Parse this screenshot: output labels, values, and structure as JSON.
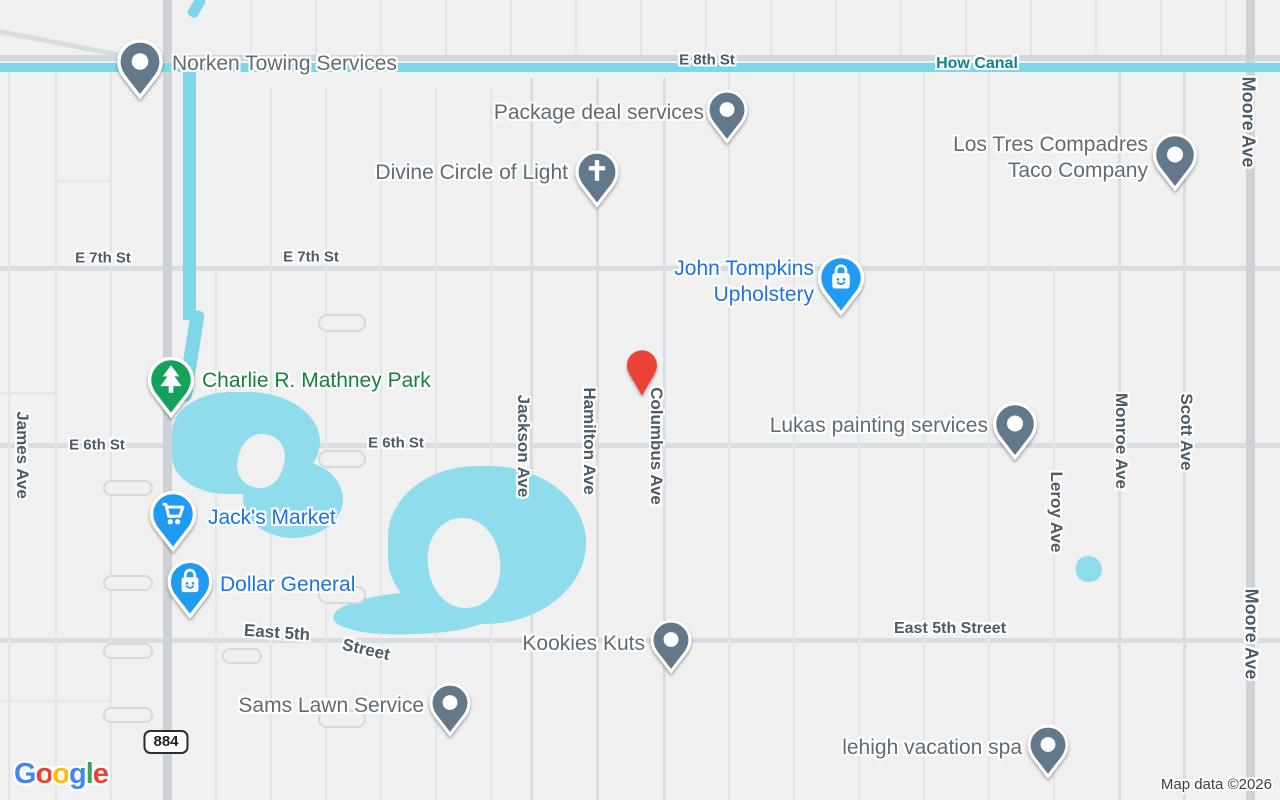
{
  "map": {
    "provider_logo": "Google",
    "logo_colors": [
      "#4285F4",
      "#EA4335",
      "#FBBC05",
      "#4285F4",
      "#34A853",
      "#EA4335"
    ],
    "attribution": "Map data ©2026",
    "route_shield": "884",
    "colors": {
      "background": "#f1f0f1",
      "water": "#8edcec",
      "street_text": "#4b5b68",
      "canal_text": "#0d8493",
      "poi_gray": "#5e6c77",
      "poi_blue": "#1a73e8",
      "poi_green": "#188038",
      "pin_gray": "#63798a",
      "pin_blue": "#1f9bf2",
      "pin_green": "#14a15c",
      "pin_red": "#EA4335"
    },
    "street_labels": [
      {
        "text": "E 8th St",
        "x": 707,
        "y": 60,
        "rot": 0,
        "kind": "street"
      },
      {
        "text": "How Canal",
        "x": 977,
        "y": 64,
        "rot": 0,
        "kind": "water-name"
      },
      {
        "text": "E 7th St",
        "x": 103,
        "y": 258,
        "rot": 0,
        "kind": "street"
      },
      {
        "text": "E 7th St",
        "x": 311,
        "y": 257,
        "rot": 0,
        "kind": "street"
      },
      {
        "text": "E 6th St",
        "x": 97,
        "y": 445,
        "rot": 0,
        "kind": "street"
      },
      {
        "text": "E 6th St",
        "x": 396,
        "y": 443,
        "rot": 0,
        "kind": "street"
      },
      {
        "text": "East 5th",
        "x": 277,
        "y": 633,
        "rot": 4,
        "kind": "street-xl"
      },
      {
        "text": "Street",
        "x": 366,
        "y": 650,
        "rot": 13,
        "kind": "street-xl"
      },
      {
        "text": "East 5th Street",
        "x": 950,
        "y": 629,
        "rot": 0,
        "kind": "street-lg"
      },
      {
        "text": "James Ave",
        "x": 22,
        "y": 455,
        "rot": 90,
        "kind": "street-xl"
      },
      {
        "text": "Jackson Ave",
        "x": 523,
        "y": 446,
        "rot": 90,
        "kind": "street-xl"
      },
      {
        "text": "Hamilton Ave",
        "x": 589,
        "y": 441,
        "rot": 90,
        "kind": "street-xl"
      },
      {
        "text": "Columbus Ave",
        "x": 656,
        "y": 446,
        "rot": 90,
        "kind": "street-xl"
      },
      {
        "text": "Leroy Ave",
        "x": 1056,
        "y": 512,
        "rot": 90,
        "kind": "street-xl"
      },
      {
        "text": "Monroe Ave",
        "x": 1121,
        "y": 441,
        "rot": 90,
        "kind": "street-xl"
      },
      {
        "text": "Scott Ave",
        "x": 1186,
        "y": 432,
        "rot": 90,
        "kind": "street-xl"
      },
      {
        "text": "Moore Ave",
        "x": 1248,
        "y": 122,
        "rot": 90,
        "kind": "street-xxl"
      },
      {
        "text": "Moore Ave",
        "x": 1251,
        "y": 634,
        "rot": 90,
        "kind": "street-xxl"
      }
    ],
    "pois": [
      {
        "id": "norken-towing-services",
        "lines": [
          "Norken Towing Services"
        ],
        "pin": {
          "x": 140,
          "y": 62,
          "size": 60,
          "icon": "dot",
          "color": "gray"
        },
        "label": {
          "x": 172,
          "y": 64,
          "anchor": "left",
          "color": "gray"
        }
      },
      {
        "id": "package-deal-services",
        "lines": [
          "Package deal services"
        ],
        "pin": {
          "x": 727,
          "y": 110,
          "size": 54,
          "icon": "dot",
          "color": "gray"
        },
        "label": {
          "x": 704,
          "y": 113,
          "anchor": "right",
          "color": "gray"
        }
      },
      {
        "id": "divine-circle-of-light",
        "lines": [
          "Divine Circle of Light"
        ],
        "pin": {
          "x": 597,
          "y": 172,
          "size": 57,
          "icon": "cross",
          "color": "gray"
        },
        "label": {
          "x": 568,
          "y": 173,
          "anchor": "right",
          "color": "gray"
        }
      },
      {
        "id": "los-tres-compadres-taco-company",
        "lines": [
          "Los Tres Compadres",
          "Taco Company"
        ],
        "pin": {
          "x": 1175,
          "y": 155,
          "size": 58,
          "icon": "dot",
          "color": "gray"
        },
        "label": {
          "x": 1148,
          "y": 158,
          "anchor": "right",
          "color": "gray"
        }
      },
      {
        "id": "john-tompkins-upholstery",
        "lines": [
          "John Tompkins",
          "Upholstery"
        ],
        "pin": {
          "x": 841,
          "y": 278,
          "size": 61,
          "icon": "bag",
          "color": "blue"
        },
        "label": {
          "x": 814,
          "y": 282,
          "anchor": "right",
          "color": "blue"
        }
      },
      {
        "id": "charlie-r-mathney-park",
        "lines": [
          "Charlie R. Mathney Park"
        ],
        "pin": {
          "x": 171,
          "y": 380,
          "size": 61,
          "icon": "tree",
          "color": "green"
        },
        "label": {
          "x": 202,
          "y": 381,
          "anchor": "left",
          "color": "green"
        }
      },
      {
        "id": "lukas-painting-services",
        "lines": [
          "Lukas painting services"
        ],
        "pin": {
          "x": 1015,
          "y": 424,
          "size": 58,
          "icon": "dot",
          "color": "gray"
        },
        "label": {
          "x": 988,
          "y": 426,
          "anchor": "right",
          "color": "gray"
        }
      },
      {
        "id": "jacks-market",
        "lines": [
          "Jack's Market"
        ],
        "pin": {
          "x": 173,
          "y": 514,
          "size": 61,
          "icon": "cart",
          "color": "blue"
        },
        "label": {
          "x": 208,
          "y": 518,
          "anchor": "left",
          "color": "blue"
        }
      },
      {
        "id": "dollar-general",
        "lines": [
          "Dollar General"
        ],
        "pin": {
          "x": 190,
          "y": 582,
          "size": 59,
          "icon": "bag",
          "color": "blue"
        },
        "label": {
          "x": 220,
          "y": 585,
          "anchor": "left",
          "color": "blue"
        }
      },
      {
        "id": "kookies-kuts",
        "lines": [
          "Kookies Kuts"
        ],
        "pin": {
          "x": 671,
          "y": 640,
          "size": 54,
          "icon": "dot",
          "color": "gray"
        },
        "label": {
          "x": 645,
          "y": 644,
          "anchor": "right",
          "color": "gray"
        }
      },
      {
        "id": "sams-lawn-service",
        "lines": [
          "Sams Lawn Service"
        ],
        "pin": {
          "x": 450,
          "y": 703,
          "size": 54,
          "icon": "dot",
          "color": "gray"
        },
        "label": {
          "x": 424,
          "y": 706,
          "anchor": "right",
          "color": "gray"
        }
      },
      {
        "id": "lehigh-vacation-spa",
        "lines": [
          "lehigh vacation spa"
        ],
        "pin": {
          "x": 1048,
          "y": 745,
          "size": 54,
          "icon": "dot",
          "color": "gray"
        },
        "label": {
          "x": 1022,
          "y": 748,
          "anchor": "right",
          "color": "gray"
        }
      }
    ],
    "dropped_pin": {
      "x": 642,
      "y": 402
    }
  }
}
